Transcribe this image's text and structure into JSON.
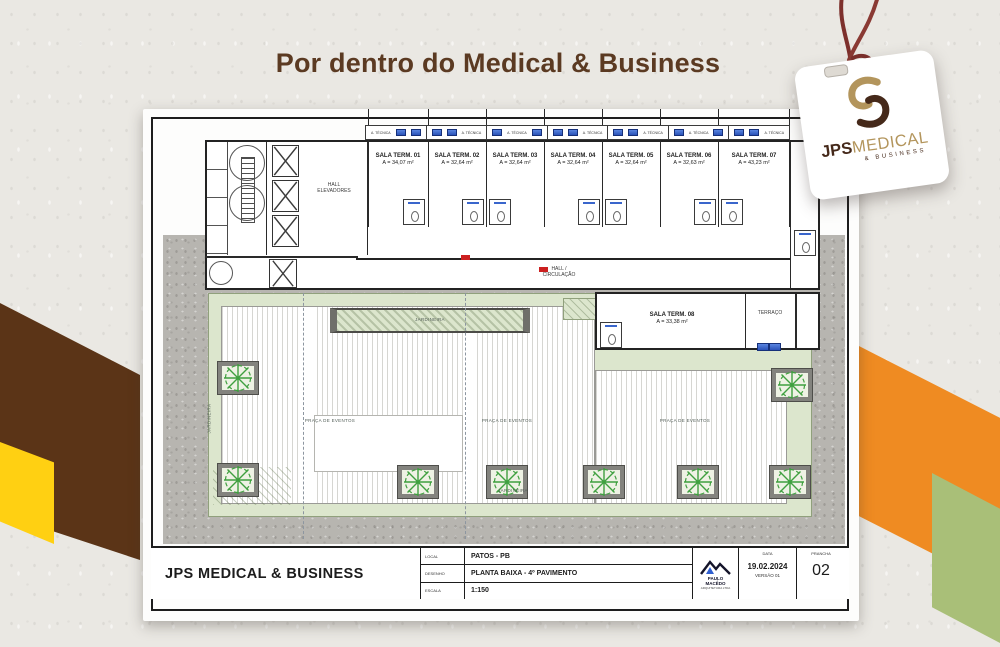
{
  "header": {
    "title": "Por dentro do Medical & Business"
  },
  "tag": {
    "jps": "JPS",
    "medical": "MEDICAL",
    "business": "& BUSINESS"
  },
  "plan": {
    "area_tecnica": "A. TÉCNICA",
    "hall_elevadores": "HALL ELEVADORES",
    "hall_circulacao": "HALL / CIRCULAÇÃO",
    "terraco": "TERRAÇO",
    "jardineira": "JARDINEIRA",
    "praca": "PRAÇA DE EVENTOS",
    "rooms": [
      {
        "name": "SALA TERM. 01",
        "area": "A = 34,07 m²"
      },
      {
        "name": "SALA TERM. 02",
        "area": "A = 32,64 m²"
      },
      {
        "name": "SALA TERM. 03",
        "area": "A = 32,64 m²"
      },
      {
        "name": "SALA TERM. 04",
        "area": "A = 32,64 m²"
      },
      {
        "name": "SALA TERM. 05",
        "area": "A = 32,64 m²"
      },
      {
        "name": "SALA TERM. 06",
        "area": "A = 32,63 m²"
      },
      {
        "name": "SALA TERM. 07",
        "area": "A = 43,23 m²"
      },
      {
        "name": "SALA TERM. 08",
        "area": "A = 33,38 m²"
      }
    ]
  },
  "title_block": {
    "project": "JPS MEDICAL & BUSINESS",
    "local_label": "LOCAL",
    "local_value": "PATOS - PB",
    "desenho_label": "DESENHO",
    "desenho_value": "PLANTA BAIXA - 4º PAVIMENTO",
    "escala_label": "ESCALA",
    "escala_value": "1:150",
    "architect_name_1": "PAULO",
    "architect_name_2": "MACÊDO",
    "architect_firm": "ARQUITETURA LTDA",
    "data_label": "DATA",
    "date": "19.02.2024",
    "version": "VERSÃO 01",
    "prancha_label": "PRANCHA",
    "prancha_number": "02"
  },
  "colors": {
    "accent_brown": "#5b3417",
    "accent_yellow": "#ffd012",
    "accent_orange": "#ef8b22",
    "accent_olive": "#a9bf78",
    "tag_string": "#7d302c",
    "logo_gold": "#b3955c",
    "logo_brown": "#45291a",
    "ac_unit_blue": "#3a66cc",
    "title_brown": "#5b3a22"
  }
}
